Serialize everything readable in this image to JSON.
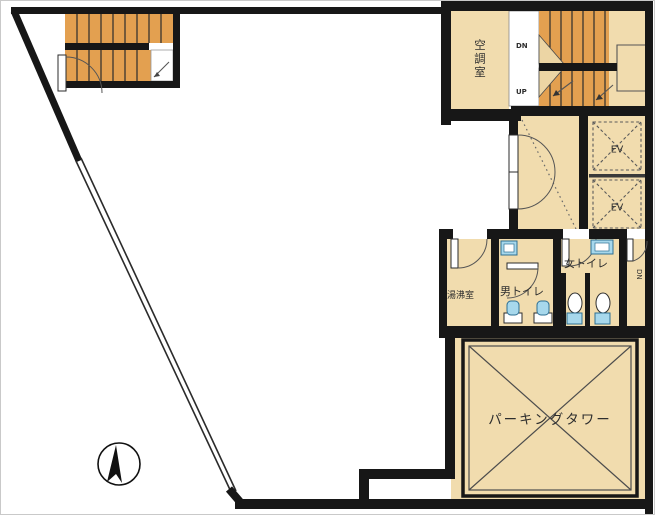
{
  "plan": {
    "type": "building-floor-plan",
    "labels": {
      "hvac_room": "空調室",
      "stair_down": "DN",
      "stair_up": "UP",
      "elevator_1": "EV",
      "elevator_2": "EV",
      "womens_toilet": "女トイレ",
      "mens_toilet": "男トイレ",
      "utility_room": "湯沸室",
      "service_stair_down": "DN",
      "parking_tower": "パーキングタワー"
    },
    "colors": {
      "wall": "#171717",
      "room_fill": "#f1dcae",
      "stair_fill": "#e3a050",
      "fixture_blue": "#a7d8ec",
      "fixture_blue_outline": "#2e6f93",
      "background": "#ffffff"
    }
  }
}
